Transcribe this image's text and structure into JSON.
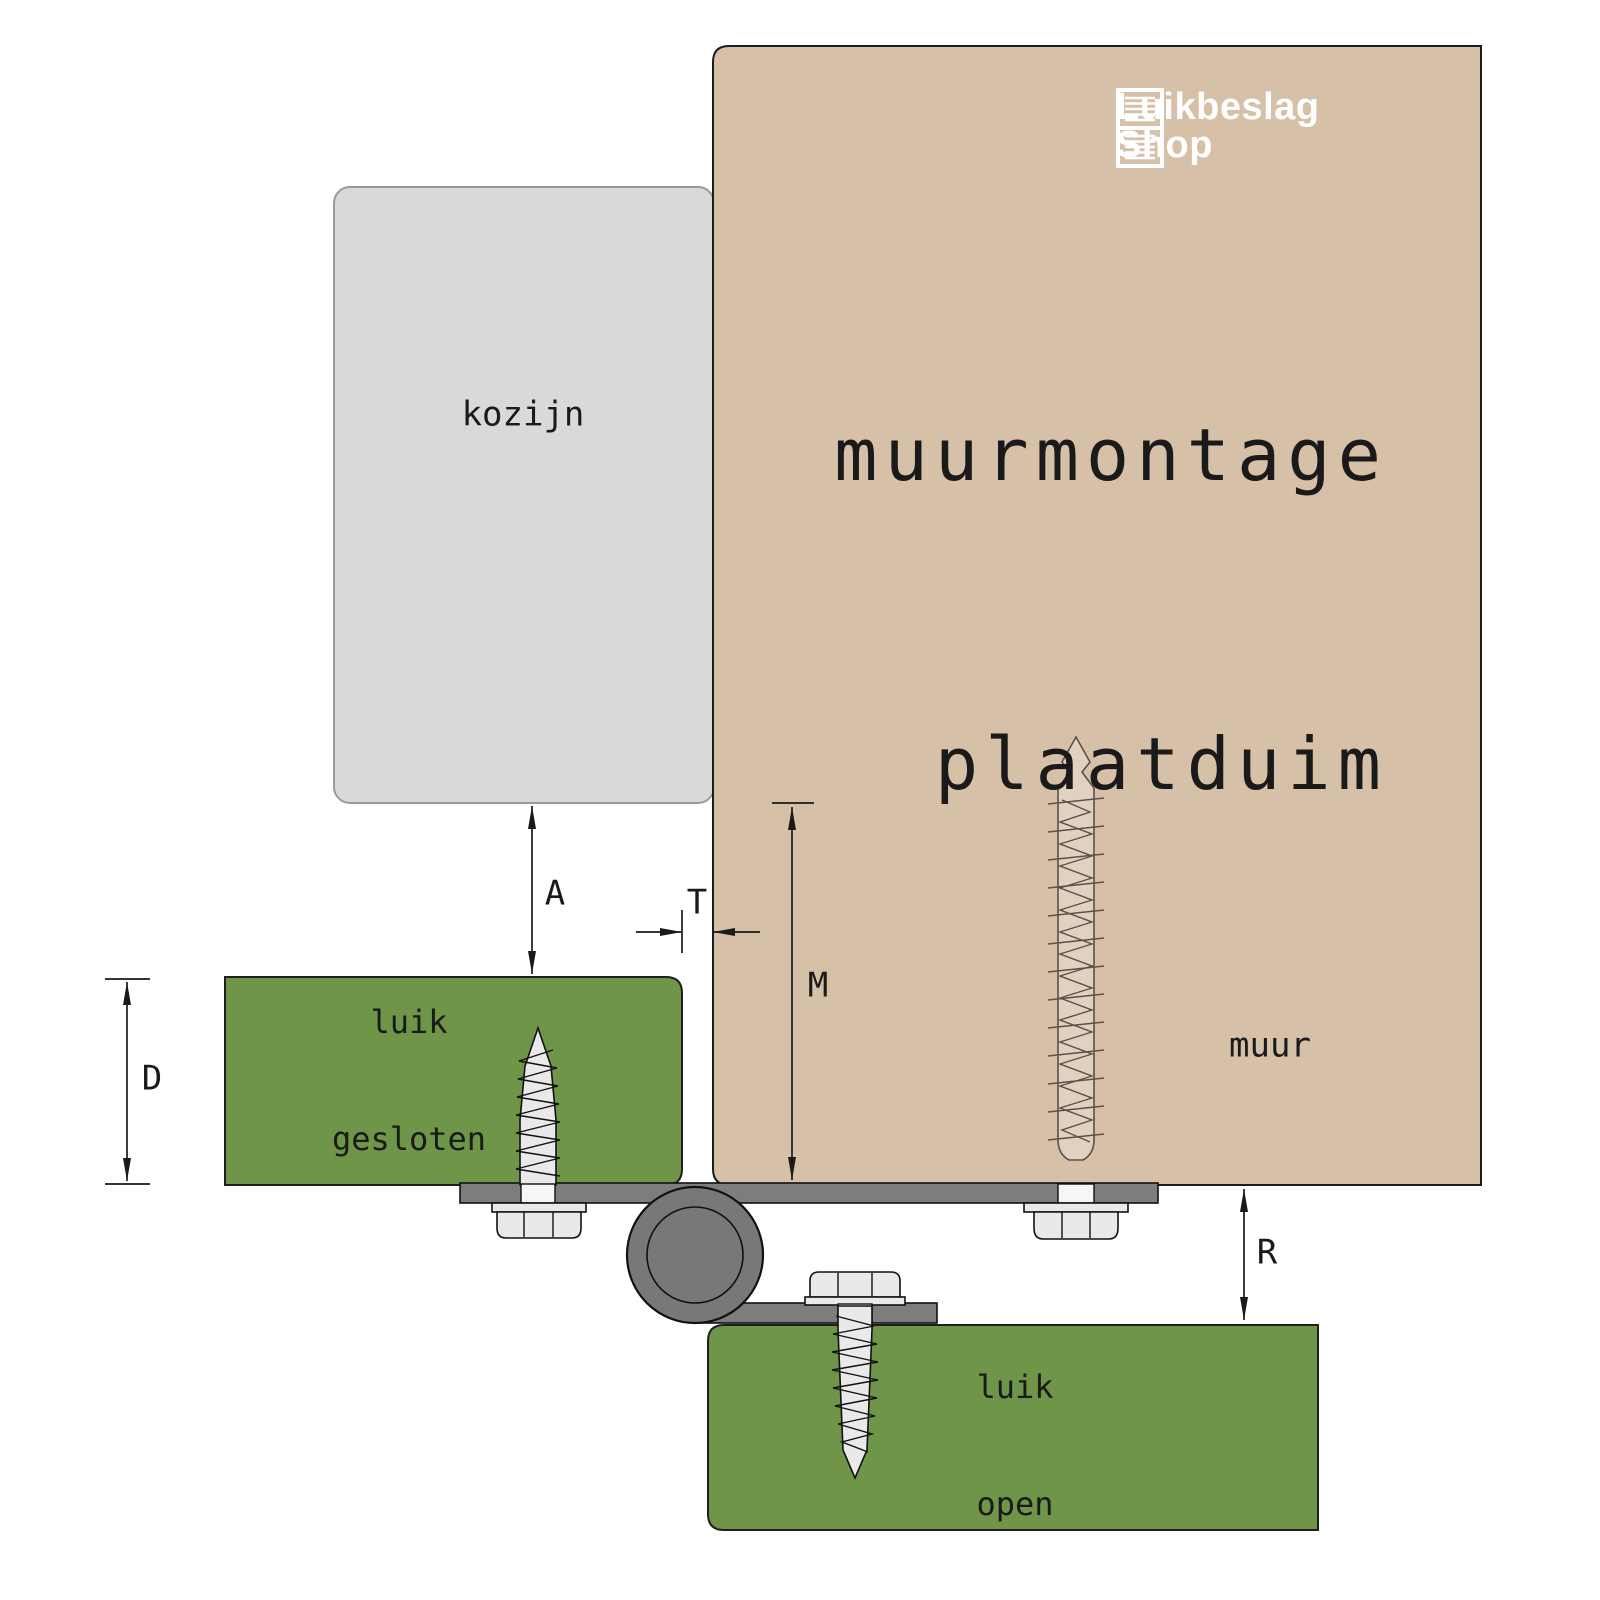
{
  "meta": {
    "kind": "technical-diagram",
    "subject": "wall-mount shutter hinge"
  },
  "logo": {
    "line1": "Luikbeslag",
    "line2": "Shop",
    "icon": "shutter-icon"
  },
  "title": {
    "line1": "muurmontage",
    "line2": "plaatduim"
  },
  "parts": {
    "frame": {
      "label": "kozijn"
    },
    "wall": {
      "label": "muur"
    },
    "shutter_closed": {
      "label_line1": "luik",
      "label_line2": "gesloten"
    },
    "shutter_open": {
      "label_line1": "luik",
      "label_line2": "open"
    }
  },
  "dimensions": {
    "a": "A",
    "t": "T",
    "m": "M",
    "d": "D",
    "r": "R"
  },
  "colors": {
    "wall": "#d6c0a8",
    "wall_stroke": "#1c1c1c",
    "frame": "#d9d9d9",
    "frame_stroke": "#999999",
    "shutter": "#6f9548",
    "shutter_stroke": "#1f1f1f",
    "plate": "#7d7d7d",
    "plate_stroke": "#111111",
    "pivot": "#787878",
    "metal": "#e9e9e9",
    "metal_stroke": "#111111",
    "anchor_stroke": "#5a5148",
    "ink": "#1a1a1a",
    "logo_text": "#ffffff"
  }
}
